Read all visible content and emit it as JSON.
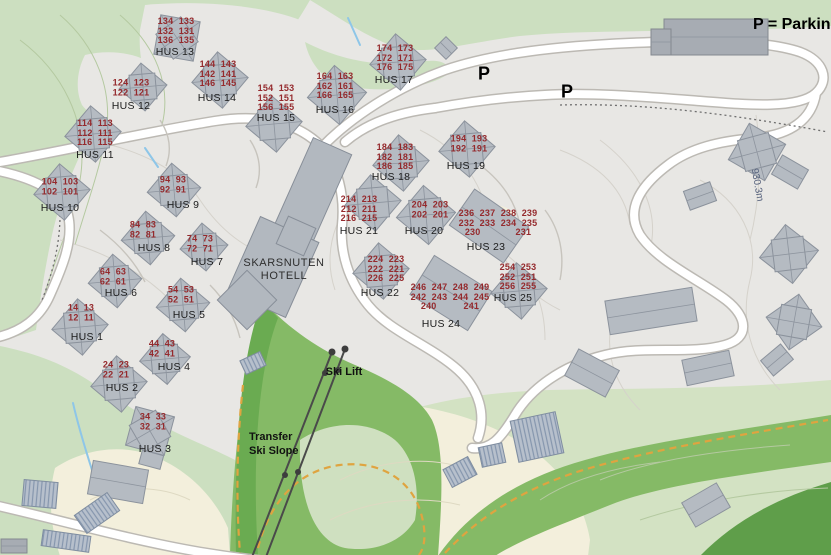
{
  "note": "P = Parking",
  "hotel": {
    "line1": "SKARSNUTEN",
    "line2": "HOTELL"
  },
  "ski_lift_label": "Ski Lift",
  "slope_label": {
    "line1": "Transfer",
    "line2": "Ski Slope"
  },
  "elevation_label": "930.3m",
  "parking_markers": [
    {
      "symbol": "P",
      "x": 484,
      "y": 74
    },
    {
      "symbol": "P",
      "x": 567,
      "y": 92
    }
  ],
  "colors": {
    "base_gray": "#e8e7e4",
    "pale_green": "#ccdfc0",
    "pale_green_right": "#d3e2c3",
    "medium_green": "#85ba66",
    "dark_green": "#5f9e4a",
    "cream": "#f3efdc",
    "road": "#ffffff",
    "house_number_red": "#952a2d",
    "label_black": "#1c1c1c",
    "building_gray": "#b5bbc2",
    "stream_blue": "#8ec6e8",
    "trail_orange": "#dfa440"
  },
  "clusters": [
    {
      "id": 1,
      "label": "HUS 1",
      "lx": 87,
      "ly": 337,
      "nx": 81,
      "ny": 313,
      "rows": [
        "14  13",
        "12  11"
      ],
      "b": {
        "x": 80,
        "y": 327,
        "s": 40,
        "r": 40
      }
    },
    {
      "id": 2,
      "label": "HUS 2",
      "lx": 122,
      "ly": 388,
      "nx": 116,
      "ny": 370,
      "rows": [
        "24  23",
        "22  21"
      ],
      "b": {
        "x": 119,
        "y": 384,
        "s": 40,
        "r": 40
      }
    },
    {
      "id": 3,
      "label": "HUS 3",
      "lx": 155,
      "ly": 449,
      "nx": 153,
      "ny": 422,
      "rows": [
        "34  33",
        "32  31"
      ],
      "b": {
        "x": 150,
        "y": 431,
        "s": 40,
        "r": 15
      }
    },
    {
      "id": 4,
      "label": "HUS 4",
      "lx": 174,
      "ly": 367,
      "nx": 162,
      "ny": 349,
      "rows": [
        "44  43",
        "42  41"
      ],
      "b": {
        "x": 165,
        "y": 359,
        "s": 36,
        "r": 40
      }
    },
    {
      "id": 5,
      "label": "HUS 5",
      "lx": 189,
      "ly": 315,
      "nx": 181,
      "ny": 295,
      "rows": [
        "54  53",
        "52  51"
      ],
      "b": {
        "x": 183,
        "y": 305,
        "s": 38,
        "r": 40
      }
    },
    {
      "id": 6,
      "label": "HUS 6",
      "lx": 121,
      "ly": 293,
      "nx": 113,
      "ny": 277,
      "rows": [
        "64  63",
        "62  61"
      ],
      "b": {
        "x": 115,
        "y": 281,
        "s": 38,
        "r": 40
      }
    },
    {
      "id": 7,
      "label": "HUS 7",
      "lx": 207,
      "ly": 262,
      "nx": 200,
      "ny": 244,
      "rows": [
        "74  73",
        "72  71"
      ],
      "b": {
        "x": 204,
        "y": 247,
        "s": 34,
        "r": 40
      }
    },
    {
      "id": 8,
      "label": "HUS 8",
      "lx": 154,
      "ly": 248,
      "nx": 143,
      "ny": 230,
      "rows": [
        "84  83",
        "82  81"
      ],
      "b": {
        "x": 148,
        "y": 238,
        "s": 38,
        "r": 40
      }
    },
    {
      "id": 9,
      "label": "HUS 9",
      "lx": 183,
      "ly": 205,
      "nx": 173,
      "ny": 185,
      "rows": [
        "94  93",
        "92  91"
      ],
      "b": {
        "x": 174,
        "y": 190,
        "s": 38,
        "r": 40
      }
    },
    {
      "id": 10,
      "label": "HUS 10",
      "lx": 60,
      "ly": 208,
      "nx": 60,
      "ny": 187,
      "rows": [
        "104  103",
        "102  101"
      ],
      "b": {
        "x": 62,
        "y": 192,
        "s": 40,
        "r": 40
      }
    },
    {
      "id": 11,
      "label": "HUS 11",
      "lx": 95,
      "ly": 155,
      "nx": 95,
      "ny": 133,
      "rows": [
        "114  113",
        "112  111",
        "116  115"
      ],
      "b": {
        "x": 93,
        "y": 134,
        "s": 40,
        "r": 40
      }
    },
    {
      "id": 12,
      "label": "HUS 12",
      "lx": 131,
      "ly": 106,
      "nx": 131,
      "ny": 88,
      "rows": [
        "124  123",
        "122  121"
      ],
      "b": {
        "x": 143,
        "y": 87,
        "s": 34,
        "r": 40
      }
    },
    {
      "id": 13,
      "label": "HUS 13",
      "lx": 175,
      "ly": 52,
      "nx": 176,
      "ny": 31,
      "rows": [
        "134  133",
        "132  131",
        "136  135"
      ],
      "b": {
        "x": 177,
        "y": 38,
        "s": 40,
        "r": 10
      }
    },
    {
      "id": 14,
      "label": "HUS 14",
      "lx": 217,
      "ly": 98,
      "nx": 218,
      "ny": 74,
      "rows": [
        "144  143",
        "142  141",
        "146  145"
      ],
      "b": {
        "x": 220,
        "y": 80,
        "s": 40,
        "r": 40
      }
    },
    {
      "id": 15,
      "label": "HUS 15",
      "lx": 276,
      "ly": 118,
      "nx": 276,
      "ny": 98,
      "rows": [
        "154  153",
        "152  151",
        "156  155"
      ],
      "b": {
        "x": 274,
        "y": 124,
        "s": 40,
        "r": 40
      }
    },
    {
      "id": 16,
      "label": "HUS 16",
      "lx": 335,
      "ly": 110,
      "nx": 335,
      "ny": 86,
      "rows": [
        "164  163",
        "162  161",
        "166  165"
      ],
      "b": {
        "x": 337,
        "y": 95,
        "s": 42,
        "r": 40
      }
    },
    {
      "id": 17,
      "label": "HUS 17",
      "lx": 394,
      "ly": 80,
      "nx": 395,
      "ny": 58,
      "rows": [
        "174  173",
        "172  171",
        "176  175"
      ],
      "b": {
        "x": 398,
        "y": 62,
        "s": 40,
        "r": 40
      }
    },
    {
      "id": 18,
      "label": "HUS 18",
      "lx": 391,
      "ly": 177,
      "nx": 395,
      "ny": 157,
      "rows": [
        "184  183",
        "182  181",
        "186  185"
      ],
      "b": {
        "x": 401,
        "y": 163,
        "s": 40,
        "r": 40
      }
    },
    {
      "id": 19,
      "label": "HUS 19",
      "lx": 466,
      "ly": 166,
      "nx": 469,
      "ny": 144,
      "rows": [
        "194  193",
        "192  191"
      ],
      "b": {
        "x": 467,
        "y": 149,
        "s": 40,
        "r": 40
      }
    },
    {
      "id": 20,
      "label": "HUS 20",
      "lx": 424,
      "ly": 231,
      "nx": 430,
      "ny": 210,
      "rows": [
        "204  203",
        "202  201"
      ],
      "b": {
        "x": 426,
        "y": 215,
        "s": 42,
        "r": 40
      }
    },
    {
      "id": 21,
      "label": "HUS 21",
      "lx": 359,
      "ly": 231,
      "nx": 359,
      "ny": 209,
      "rows": [
        "214  213",
        "212  211",
        "216  215"
      ],
      "b": {
        "x": 373,
        "y": 203,
        "s": 40,
        "r": 40
      }
    },
    {
      "id": 22,
      "label": "HUS 22",
      "lx": 380,
      "ly": 293,
      "nx": 386,
      "ny": 269,
      "rows": [
        "224  223",
        "222  221",
        "226  225"
      ],
      "b": {
        "x": 381,
        "y": 271,
        "s": 40,
        "r": 40
      }
    },
    {
      "id": 23,
      "label": "HUS 23",
      "lx": 486,
      "ly": 247,
      "nx": 498,
      "ny": 223,
      "rows": [
        "236  237  238  239",
        "232  233  234  235",
        "230             231"
      ],
      "b": {
        "x": 489,
        "y": 226,
        "w": 66,
        "h": 44,
        "r": 35,
        "t": "rect"
      }
    },
    {
      "id": 24,
      "label": "HUS 24",
      "lx": 441,
      "ly": 324,
      "nx": 450,
      "ny": 297,
      "rows": [
        "246  247  248  249",
        "242  243  244  245",
        "240          241"
      ],
      "b": {
        "x": 451,
        "y": 293,
        "w": 68,
        "h": 46,
        "r": 32,
        "t": "rect"
      }
    },
    {
      "id": 25,
      "label": "HUS 25",
      "lx": 513,
      "ly": 298,
      "nx": 518,
      "ny": 277,
      "rows": [
        "254  253",
        "252  251",
        "256  255"
      ],
      "b": {
        "x": 519,
        "y": 291,
        "s": 40,
        "r": 40
      }
    }
  ],
  "buildings": [
    {
      "name": "hotel-wing-north",
      "x": 313,
      "y": 190,
      "w": 42,
      "h": 96,
      "r": 24,
      "t": "hotel"
    },
    {
      "name": "hotel-wing-south",
      "x": 273,
      "y": 267,
      "w": 64,
      "h": 82,
      "r": 24,
      "t": "hotel"
    },
    {
      "name": "hotel-annex",
      "x": 247,
      "y": 300,
      "w": 42,
      "h": 42,
      "r": 45,
      "t": "hotel"
    },
    {
      "name": "hotel-connector",
      "x": 296,
      "y": 236,
      "w": 30,
      "h": 30,
      "r": 24,
      "t": "hotel"
    },
    {
      "name": "parking-garage",
      "x": 716,
      "y": 37,
      "w": 104,
      "h": 36,
      "r": 0,
      "t": "dark"
    },
    {
      "name": "parking-garage-annex",
      "x": 661,
      "y": 42,
      "w": 20,
      "h": 26,
      "r": 0,
      "t": "dark"
    },
    {
      "name": "shed",
      "x": 446,
      "y": 48,
      "w": 16,
      "h": 16,
      "r": 45,
      "t": "rect"
    },
    {
      "name": "building",
      "x": 757,
      "y": 152,
      "s": 42,
      "r": 30,
      "t": "house"
    },
    {
      "name": "building",
      "x": 790,
      "y": 172,
      "w": 30,
      "h": 22,
      "r": 30,
      "t": "rect"
    },
    {
      "name": "building",
      "x": 700,
      "y": 196,
      "w": 28,
      "h": 20,
      "r": -20,
      "t": "rect"
    },
    {
      "name": "building",
      "x": 651,
      "y": 311,
      "w": 88,
      "h": 34,
      "r": -9,
      "t": "rect"
    },
    {
      "name": "building",
      "x": 789,
      "y": 254,
      "s": 42,
      "r": 38,
      "t": "house"
    },
    {
      "name": "building",
      "x": 794,
      "y": 322,
      "s": 40,
      "r": -35,
      "t": "house"
    },
    {
      "name": "building",
      "x": 777,
      "y": 360,
      "w": 26,
      "h": 20,
      "r": -40,
      "t": "rect"
    },
    {
      "name": "building",
      "x": 708,
      "y": 368,
      "w": 48,
      "h": 26,
      "r": -12,
      "t": "rect"
    },
    {
      "name": "building",
      "x": 592,
      "y": 373,
      "w": 46,
      "h": 30,
      "r": 28,
      "t": "rect"
    },
    {
      "name": "building",
      "x": 537,
      "y": 437,
      "w": 46,
      "h": 42,
      "r": -12,
      "t": "hatch"
    },
    {
      "name": "building",
      "x": 492,
      "y": 455,
      "w": 24,
      "h": 20,
      "r": -12,
      "t": "hatch"
    },
    {
      "name": "building",
      "x": 460,
      "y": 472,
      "w": 28,
      "h": 20,
      "r": -28,
      "t": "hatch"
    },
    {
      "name": "building",
      "x": 706,
      "y": 505,
      "w": 40,
      "h": 28,
      "r": -30,
      "t": "rect"
    },
    {
      "name": "building",
      "x": 118,
      "y": 482,
      "w": 56,
      "h": 34,
      "r": 10,
      "t": "rect"
    },
    {
      "name": "building",
      "x": 97,
      "y": 513,
      "w": 40,
      "h": 22,
      "r": -35,
      "t": "hatch"
    },
    {
      "name": "building",
      "x": 40,
      "y": 494,
      "w": 34,
      "h": 26,
      "r": 5,
      "t": "hatch"
    },
    {
      "name": "building",
      "x": 66,
      "y": 541,
      "w": 48,
      "h": 16,
      "r": 8,
      "t": "hatch"
    },
    {
      "name": "building",
      "x": 14,
      "y": 546,
      "w": 26,
      "h": 14,
      "r": 0,
      "t": "dark"
    },
    {
      "name": "lift-station-hut",
      "x": 253,
      "y": 363,
      "w": 22,
      "h": 15,
      "r": -25,
      "t": "hatch"
    },
    {
      "name": "hus3-annex",
      "x": 153,
      "y": 453,
      "w": 22,
      "h": 28,
      "r": 15,
      "t": "rect"
    }
  ]
}
